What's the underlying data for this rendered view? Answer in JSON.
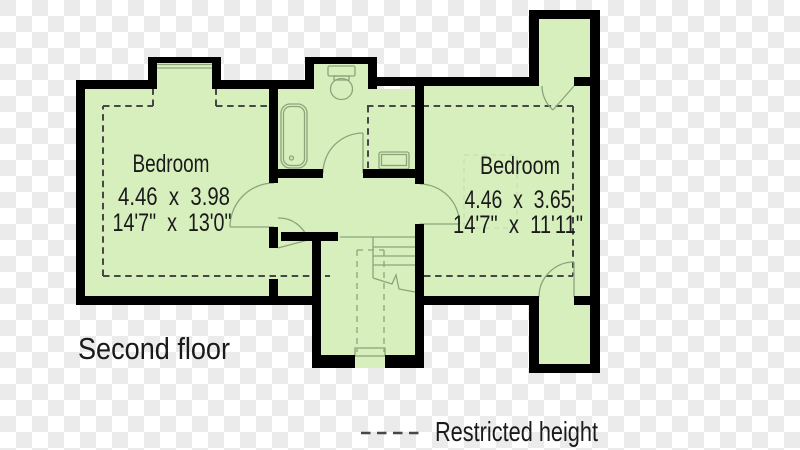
{
  "page_title": "Second floor floorplan",
  "floor_label": "Second floor",
  "rooms": [
    {
      "name": "Bedroom",
      "metric": "4.46  x  3.98",
      "imperial": "14'7\"  x  13'0\""
    },
    {
      "name": "Bedroom",
      "metric": "4.46  x  3.65",
      "imperial": "14'7\"  x  11'11\""
    }
  ],
  "legend": {
    "label": "Restricted height",
    "line_style": "dashed"
  },
  "fixtures": [
    "bathtub",
    "toilet",
    "sink",
    "staircase"
  ],
  "colors": {
    "floor_fill": "#d7efbd",
    "wall": "#000000",
    "fixture_line": "#8ba47b",
    "restricted_dash": "#474747",
    "wardrobe_dash": "#c9e2b2",
    "checker_light": "#ffffff",
    "checker_dark": "#ebebeb",
    "text": "#1a1a1a"
  }
}
